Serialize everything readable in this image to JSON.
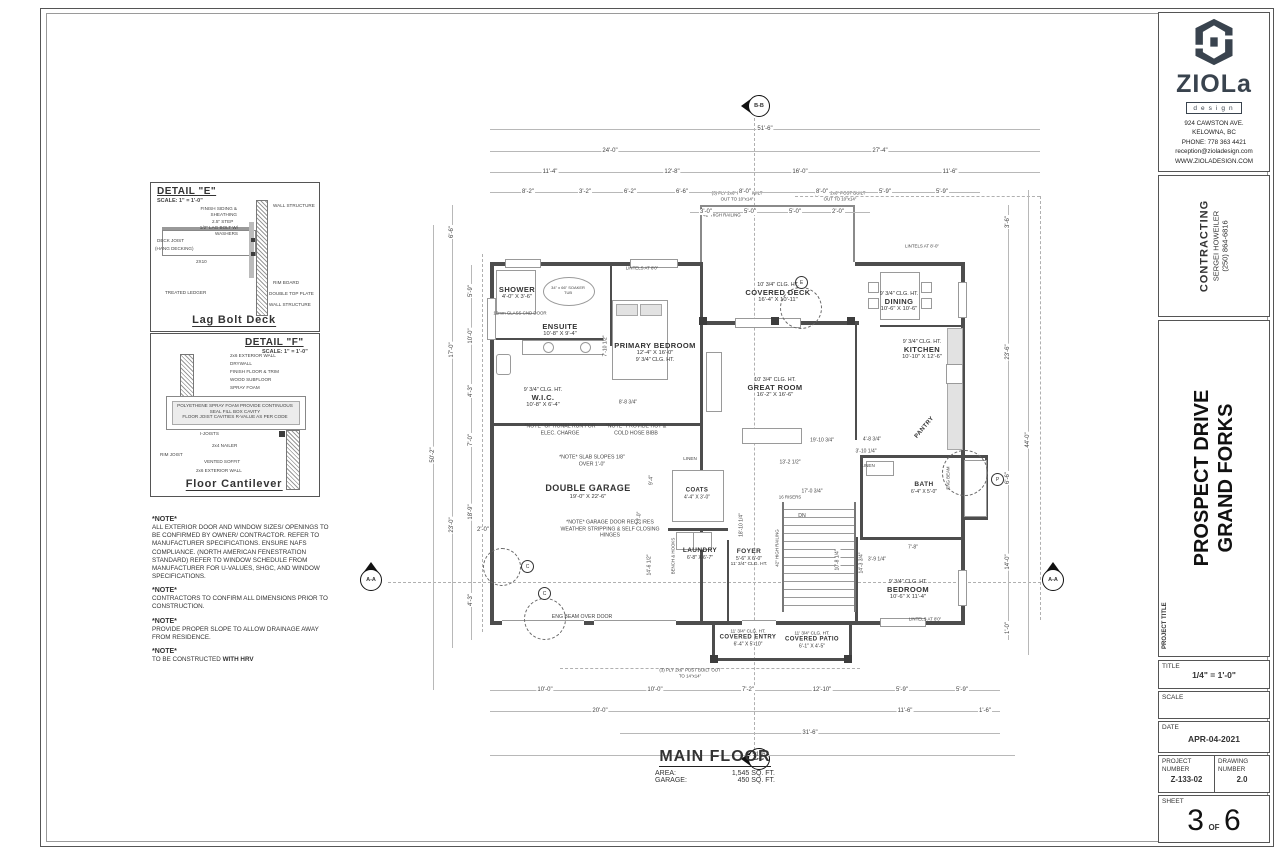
{
  "title_block": {
    "logo": {
      "brand": "ZIOLa",
      "brand_sub": "design",
      "address1": "924 CAWSTON AVE.",
      "address2": "KELOWNA, BC",
      "phone": "PHONE: 778 363 4421",
      "email": "reception@zioladesign.com",
      "website": "WWW.ZIOLADESIGN.COM"
    },
    "contracting": {
      "heading": "CONTRACTING",
      "name": "SERGEI HOWEILER",
      "phone": "(250) 864-6816"
    },
    "project_title_label": "PROJECT TITLE",
    "project_line1": "PROSPECT DRIVE",
    "project_line2": "GRAND FORKS",
    "title_label": "TITLE",
    "title_value": "1/4\" = 1'-0\"",
    "scale_label": "SCALE",
    "date_label": "DATE",
    "date_value": "APR-04-2021",
    "project_number_label": "PROJECT NUMBER",
    "project_number_value": "Z-133-02",
    "drawing_number_label": "DRAWING NUMBER",
    "drawing_number_value": "2.0",
    "sheet_label": "SHEET",
    "sheet_number": "3",
    "sheet_of": "OF",
    "sheet_total": "6"
  },
  "details": {
    "e": {
      "heading": "DETAIL \"E\"",
      "scale": "SCALE: 1\" = 1'-0\"",
      "caption": "Lag Bolt Deck",
      "labels": [
        "FINISH SIDING & SHEATHING",
        "2.5\" STEP",
        "1/2\" LAG BOLT W/ WASHERS",
        "DECK JOIST",
        "(HANG DECKING)",
        "2X10",
        "TREATED LEDGER",
        "WALL STRUCTURE",
        "RIM BOARD",
        "DOUBLE TOP PLATE",
        "WALL STRUCTURE"
      ]
    },
    "f": {
      "heading": "DETAIL \"F\"",
      "scale": "SCALE: 1\" = 1'-0\"",
      "caption": "Floor Cantilever",
      "labels": [
        "2x6 EXTERIOR WALL",
        "DRYWALL",
        "FINISH FLOOR & TRIM",
        "WOOD SUBFLOOR",
        "SPRAY FOAM",
        "POLYETHENE SPRAY FOAM PROVIDE CONTINUOUS SEAL FILL BOX CAVITY",
        "FLOOR JOIST CAVITIES R-VALUE AS PER CODE",
        "I-JOISTS",
        "2x4 NAILER",
        "RIM JOIST",
        "VENTED SOFFIT",
        "2x6 EXTERIOR WALL"
      ]
    }
  },
  "notes": [
    {
      "h": "*NOTE*",
      "b": "ALL EXTERIOR DOOR AND WINDOW SIZES/ OPENINGS TO BE CONFIRMED BY OWNER/ CONTRACTOR. REFER TO MANUFACTURER SPECIFICATIONS. ENSURE NAFS COMPLIANCE. (NORTH AMERICAN FENESTRATION STANDARD) REFER TO WINDOW SCHEDULE FROM MANUFACTURER FOR U-VALUES, SHGC, AND WINDOW SPECIFICATIONS."
    },
    {
      "h": "*NOTE*",
      "b": "CONTRACTORS TO CONFIRM ALL DIMENSIONS PRIOR TO CONSTRUCTION."
    },
    {
      "h": "*NOTE*",
      "b": "PROVIDE PROPER SLOPE TO ALLOW DRAINAGE AWAY FROM RESIDENCE."
    },
    {
      "h": "*NOTE*",
      "b": "TO BE CONSTRUCTED ",
      "bold": "WITH HRV"
    }
  ],
  "plan": {
    "rooms": [
      {
        "n": "SHOWER",
        "s": "4'-0\" X 3'-6\""
      },
      {
        "n": "ENSUITE",
        "s": "10'-8\" X 9'-4\""
      },
      {
        "n": "PRIMARY BEDROOM",
        "s": "12'-4\" X 16'-0\"",
        "c": "9' 3/4\" CLG. HT."
      },
      {
        "n": "W.I.C.",
        "s": "10'-8\" X 6'-4\"",
        "c": "9' 3/4\" CLG. HT."
      },
      {
        "n": "COVERED DECK",
        "s": "16'-4\" X 10'-11\"",
        "c": "10' 3/4\" CLG. HT."
      },
      {
        "n": "DINING",
        "s": "10'-6\" X 10'-6\"",
        "c": "9' 3/4\" CLG. HT."
      },
      {
        "n": "KITCHEN",
        "s": "10'-10\" X 12'-6\"",
        "c": "9' 3/4\" CLG. HT."
      },
      {
        "n": "GREAT ROOM",
        "s": "16'-2\" X 16'-6\"",
        "c": "10' 3/4\" CLG. HT."
      },
      {
        "n": "PANTRY"
      },
      {
        "n": "DOUBLE GARAGE",
        "s": "19'-0\" X 22'-6\""
      },
      {
        "n": "COATS",
        "s": "4'-4\" X 3'-0\""
      },
      {
        "n": "LAUNDRY",
        "s": "6'-8\" X 6'-7\""
      },
      {
        "n": "FOYER",
        "s": "5'-6\" X 6'-0\"",
        "c": "11' 3/4\" CLG. HT."
      },
      {
        "n": "BATH",
        "s": "6'-4\" X 5'-0\""
      },
      {
        "n": "BEDROOM",
        "s": "10'-6\" X 11'-4\"",
        "c": "9' 3/4\" CLG. HT."
      },
      {
        "n": "COVERED ENTRY",
        "s": "6'-4\" X 5'-10\"",
        "c": "11' 3/4\" CLG. HT."
      },
      {
        "n": "COVERED PATIO",
        "s": "6'-1\" X 4'-5\"",
        "c": "11' 3/4\" CLG. HT."
      }
    ],
    "ann": [
      "42\" HIGH RAILING",
      "(3) PLY 2x6\" POST BUILT OUT TO 10\"x14\"",
      "(3) PLY 2x6\" POST BUILT OUT TO 10\"x14\"",
      "(3) PLY 2x6\" POST BUILT OUT TO 14\"x14\"",
      "*NOTE* OPTIONAL RUN FOR ELEC. CHARGE",
      "*NOTE* PROVIDE HOT & COLD HOSE BIBB",
      "*NOTE* SLAB SLOPES 1/8\" OVER 1'-0\"",
      "*NOTE* GARAGE DOOR REQUIRES WEATHER STRIPPING & SELF CLOSING HINGES",
      "ENG BEAM OVER DOOR",
      "12mm GLASS CND DOOR",
      "34\" x 66\" SOAKER TUB",
      "LINTELS AT 8'0\"",
      "LINTELS AT 8'-0\"",
      "LINTELS AT 8'0\"",
      "BENCH & HOOKS",
      "16 RISERS",
      "DN",
      "42\" HIGH RAILING",
      "LINEN",
      "LINEN",
      "ENG BEAM"
    ],
    "dims": {
      "t1": [
        "51'-6\""
      ],
      "t2": [
        "24'-0\"",
        "27'-4\""
      ],
      "t3": [
        "11'-4\"",
        "12'-8\"",
        "16'-0\"",
        "11'-6\""
      ],
      "t4": [
        "8'-2\"",
        "3'-2\"",
        "6'-2\"",
        "6'-6\"",
        "8'-0\"",
        "8'-0\"",
        "5'-9\"",
        "5'-9\""
      ],
      "t5": [
        "3'-0\"",
        "5'-0\"",
        "5'-0\"",
        "2'-0\""
      ],
      "b1": [
        "10'-0\"",
        "10'-0\"",
        "7'-2\"",
        "12'-10\"",
        "5'-9\"",
        "5'-9\""
      ],
      "b2": [
        "20'-0\"",
        "11'-6\"",
        "1'-6\""
      ],
      "b3": [
        "31'-6\""
      ],
      "b4": [
        "51'-6\""
      ],
      "l": [
        "6'-6\"",
        "17'-0\"",
        "23'-0\"",
        "50'-2\"",
        "5'-9\"",
        "10'-0\"",
        "4'-3\"",
        "7'-0\"",
        "18'-9\"",
        "4'-3\"",
        "2'-0\""
      ],
      "r": [
        "3'-6\"",
        "23'-6\"",
        "6'-6\"",
        "14'-0\"",
        "1'-0\"",
        "44'-0\""
      ],
      "i": [
        "19'-10 3/4\"",
        "13'-2 1/2\"",
        "17'-0 3/4\"",
        "18'-10 1/4\"",
        "10'-8 1/4\"",
        "14'-3 3/4\"",
        "8'-8 3/4\"",
        "7'-10 1/2\"",
        "23'-0\"",
        "14'-6 1/2\"",
        "9'-4\"",
        "3'-10 1/4\"",
        "4'-8 3/4\"",
        "7'-8\"",
        "3'-9 1/4\""
      ]
    },
    "markers": {
      "bb": "B-B",
      "aa": "A-A",
      "c": "C",
      "e": "E",
      "p": "P"
    },
    "main_floor": {
      "title": "MAIN FLOOR",
      "area_label": "AREA:",
      "area_value": "1,545 SQ. FT.",
      "garage_label": "GARAGE:",
      "garage_value": "450 SQ. FT."
    }
  }
}
